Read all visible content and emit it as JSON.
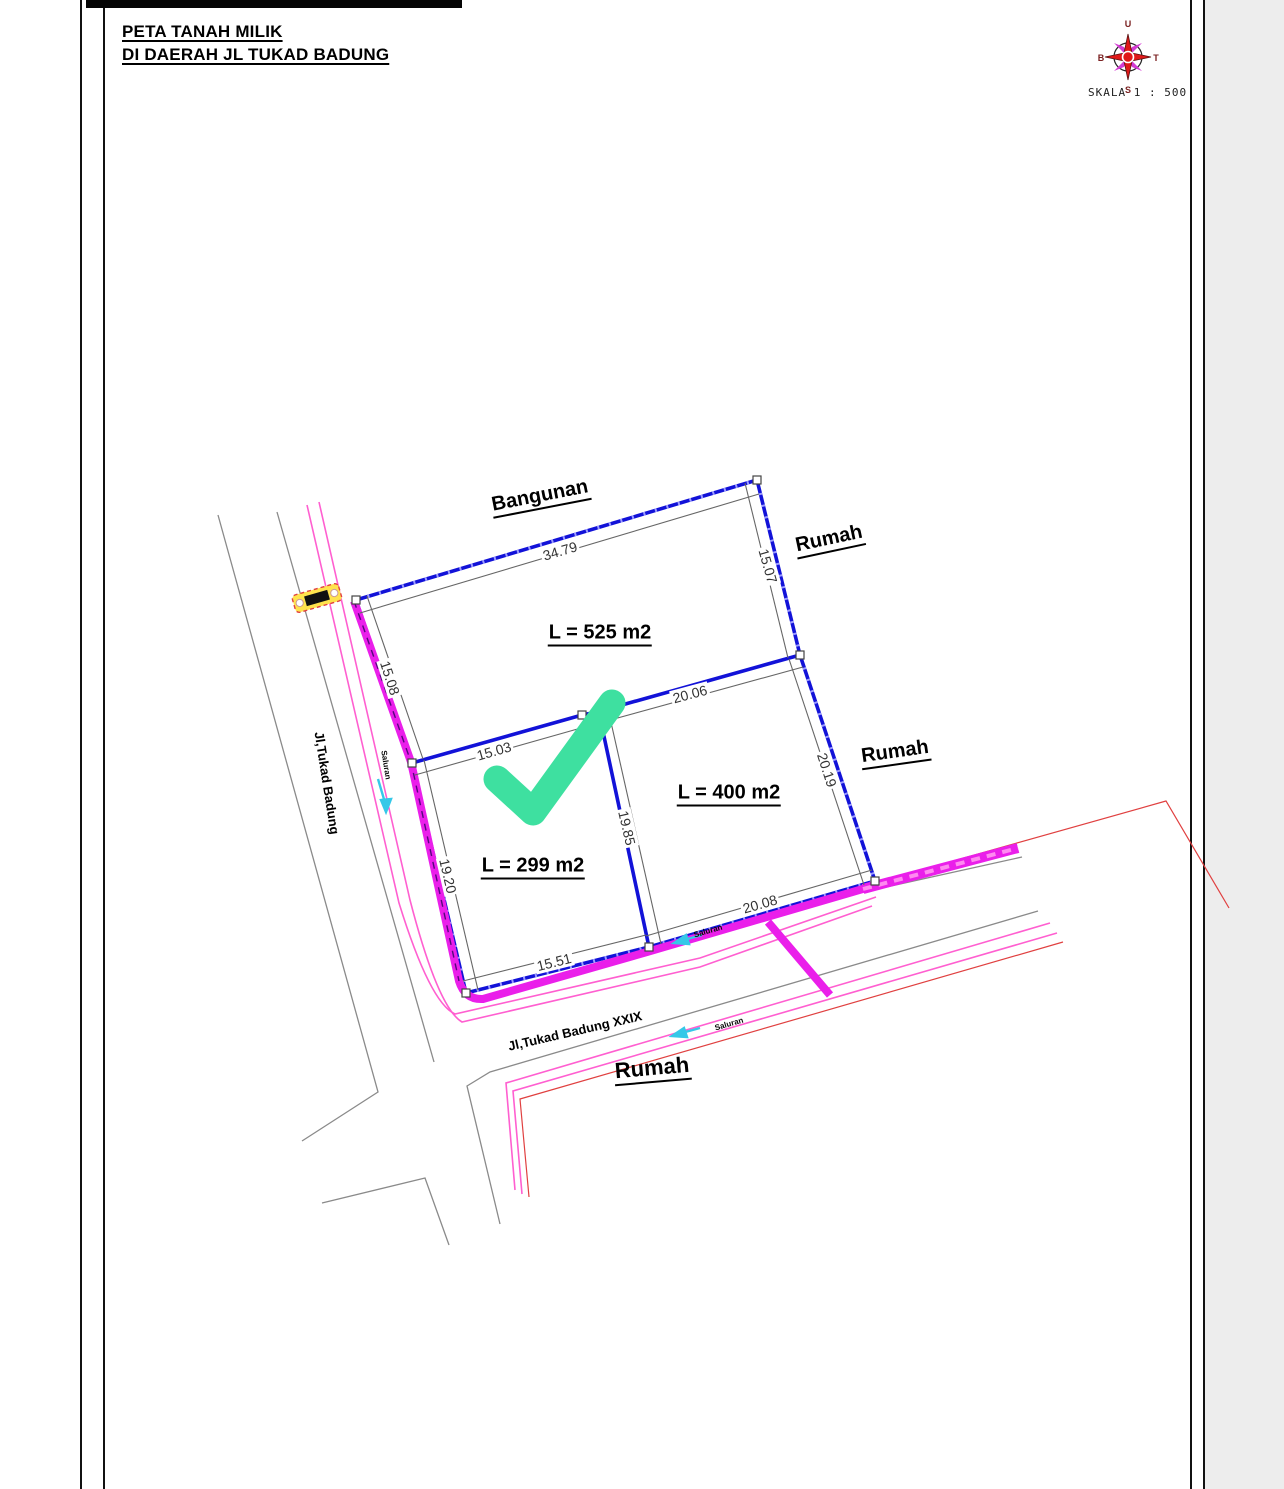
{
  "sheet": {
    "title_line1": "PETA TANAH MILIK",
    "title_line2": "DI DAERAH JL TUKAD BADUNG",
    "scale_label": "SKALA 1 : 500",
    "compass": {
      "north": "U",
      "east": "T",
      "south": "S",
      "west": "B"
    }
  },
  "colors": {
    "parcel_boundary_blue": "#1212d8",
    "road_edge_magenta": "#ea1fea",
    "road_thin_pink": "#ff5fd0",
    "neighbor_red": "#e04040",
    "road_gray": "#8a8a8a",
    "canal_cyan": "#35c8e8",
    "check_green": "#3ee0a0",
    "dimension_gray": "#666666"
  },
  "map": {
    "area_labels": [
      {
        "text": "L = 525 m2",
        "x": 600,
        "y": 633,
        "rot": 0
      },
      {
        "text": "L = 400 m2",
        "x": 729,
        "y": 793,
        "rot": 0
      },
      {
        "text": "L = 299 m2",
        "x": 533,
        "y": 866,
        "rot": 0
      }
    ],
    "place_labels": [
      {
        "text": "Bangunan",
        "x": 540,
        "y": 496,
        "rot": -11,
        "size": 20
      },
      {
        "text": "Rumah",
        "x": 829,
        "y": 539,
        "rot": -12,
        "size": 20
      },
      {
        "text": "Rumah",
        "x": 895,
        "y": 752,
        "rot": -8,
        "size": 20
      },
      {
        "text": "Rumah",
        "x": 652,
        "y": 1068,
        "rot": -5,
        "size": 22
      }
    ],
    "road_labels": [
      {
        "text": "Jl,Tukad Badung",
        "x": 327,
        "y": 783,
        "rot": 81,
        "size": 13
      },
      {
        "text": "Jl,Tukad Badung XXIX",
        "x": 575,
        "y": 1031,
        "rot": -13,
        "size": 13
      }
    ],
    "canal_labels": [
      {
        "text": "Saluran",
        "x": 386,
        "y": 765,
        "rot": 81
      },
      {
        "text": "Saluran",
        "x": 708,
        "y": 931,
        "rot": -16
      },
      {
        "text": "Saluran",
        "x": 729,
        "y": 1024,
        "rot": -16
      }
    ],
    "dimensions": [
      {
        "value": "34.79",
        "x": 560,
        "y": 551,
        "rot": -16.5
      },
      {
        "value": "15.07",
        "x": 768,
        "y": 566,
        "rot": 74
      },
      {
        "value": "15.08",
        "x": 390,
        "y": 678,
        "rot": 72
      },
      {
        "value": "20.06",
        "x": 690,
        "y": 694,
        "rot": -15
      },
      {
        "value": "15.03",
        "x": 494,
        "y": 751,
        "rot": -16
      },
      {
        "value": "20.19",
        "x": 827,
        "y": 770,
        "rot": 72
      },
      {
        "value": "19.85",
        "x": 627,
        "y": 828,
        "rot": 77
      },
      {
        "value": "19.20",
        "x": 448,
        "y": 876,
        "rot": 77
      },
      {
        "value": "20.08",
        "x": 760,
        "y": 904,
        "rot": -16
      },
      {
        "value": "15.51",
        "x": 554,
        "y": 962,
        "rot": -14
      }
    ]
  }
}
